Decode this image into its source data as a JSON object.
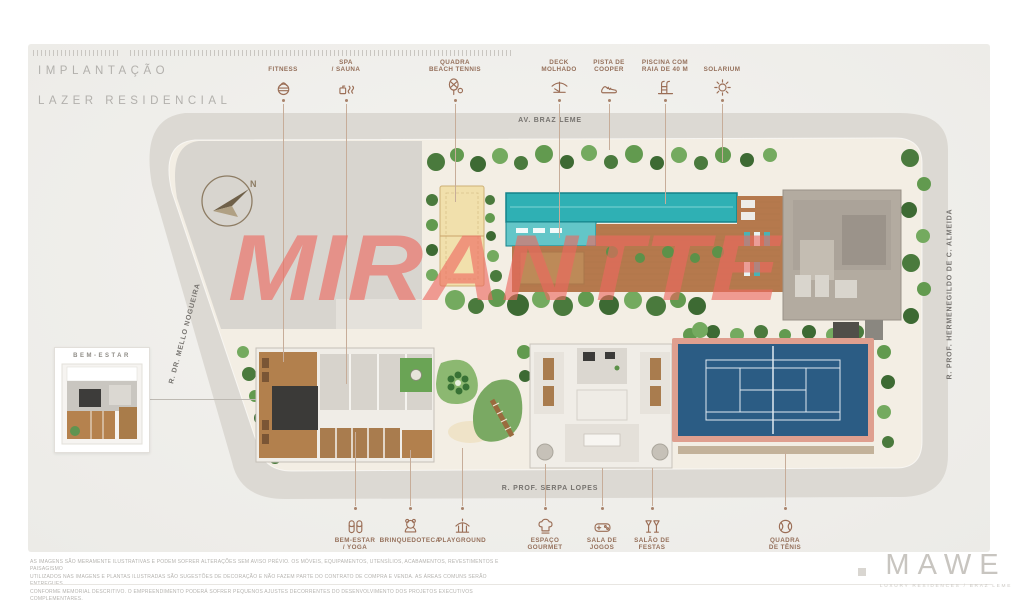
{
  "header": {
    "title_line1": "IMPLANTAÇÃO",
    "title_line2": "LAZER RESIDENCIAL"
  },
  "watermark": {
    "text": "MIRANTTE"
  },
  "north_indicator": {
    "label": "N"
  },
  "streets": {
    "top": "AV. BRAZ LEME",
    "left": "R. DR. MELLO NOGUEIRA",
    "right": "R. PROF. HERMENEGILDO DE C. ALMEIDA",
    "bottom": "R. PROF. SERPA LOPES"
  },
  "amenities_top": [
    {
      "id": "fitness",
      "lines": [
        "FITNESS"
      ],
      "icon": "kettlebell-icon"
    },
    {
      "id": "spa-sauna",
      "lines": [
        "SPA",
        "/ SAUNA"
      ],
      "icon": "sauna-icon"
    },
    {
      "id": "quadra-beach-tennis",
      "lines": [
        "QUADRA",
        "BEACH TENNIS"
      ],
      "icon": "racket-icon"
    },
    {
      "id": "deck-molhado",
      "lines": [
        "DECK",
        "MOLHADO"
      ],
      "icon": "deck-lounger-icon"
    },
    {
      "id": "pista-de-cooper",
      "lines": [
        "PISTA DE",
        "COOPER"
      ],
      "icon": "running-shoe-icon"
    },
    {
      "id": "piscina-raia-40m",
      "lines": [
        "PISCINA COM",
        "RAIA DE 40 M"
      ],
      "icon": "pool-ladder-icon"
    },
    {
      "id": "solarium",
      "lines": [
        "SOLARIUM"
      ],
      "icon": "sun-icon"
    }
  ],
  "amenities_bottom": [
    {
      "id": "bem-estar-yoga",
      "lines": [
        "BEM-ESTAR",
        "/ YOGA"
      ],
      "icon": "slippers-icon"
    },
    {
      "id": "brinquedoteca",
      "lines": [
        "BRINQUEDOTECA"
      ],
      "icon": "teddy-bear-icon"
    },
    {
      "id": "playground",
      "lines": [
        "PLAYGROUND"
      ],
      "icon": "carousel-icon"
    },
    {
      "id": "espaco-gourmet",
      "lines": [
        "ESPAÇO",
        "GOURMET"
      ],
      "icon": "chef-hat-icon"
    },
    {
      "id": "sala-de-jogos",
      "lines": [
        "SALA DE",
        "JOGOS"
      ],
      "icon": "game-controller-icon"
    },
    {
      "id": "salao-de-festas",
      "lines": [
        "SALÃO DE",
        "FESTAS"
      ],
      "icon": "toast-glasses-icon"
    },
    {
      "id": "quadra-de-tenis",
      "lines": [
        "QUADRA",
        "DE TÊNIS"
      ],
      "icon": "tennis-ball-icon"
    }
  ],
  "inset": {
    "title": "BEM-ESTAR"
  },
  "disclaimer": {
    "lines": [
      "AS IMAGENS SÃO MERAMENTE ILUSTRATIVAS E PODEM SOFRER ALTERAÇÕES SEM AVISO PRÉVIO. OS MÓVEIS, EQUIPAMENTOS, UTENSÍLIOS, ACABAMENTOS, REVESTIMENTOS E PAISAGISMO",
      "UTILIZADOS NAS IMAGENS E PLANTAS ILUSTRADAS SÃO SUGESTÕES DE DECORAÇÃO E NÃO FAZEM PARTE DO CONTRATO DE COMPRA E VENDA. AS ÁREAS COMUNS SERÃO ENTREGUES",
      "CONFORME MEMORIAL DESCRITIVO. O EMPREENDIMENTO PODERÁ SOFRER PEQUENOS AJUSTES DECORRENTES DO DESENVOLVIMENTO DOS PROJETOS EXECUTIVOS COMPLEMENTARES."
    ]
  },
  "logo": {
    "name": "MAWE",
    "tagline": "LUXURY RESIDENCES  /  BRAZ LEME"
  },
  "colors": {
    "accent": "#9b6e56",
    "watermark": "#ee685f",
    "street": "#dcd9d3",
    "site": "#f3eee4",
    "graypad": "#d8d5cf",
    "pool": "#2fb0b4",
    "pool-shallow": "#63c6c8",
    "sand": "#f1e0ac",
    "deck": "#b5794d",
    "tennis-blue": "#2b5c84",
    "tennis-frame": "#df9f8f",
    "building": "#b3aba0",
    "dark-room": "#3b3a38",
    "green": "#5d8f4e"
  }
}
